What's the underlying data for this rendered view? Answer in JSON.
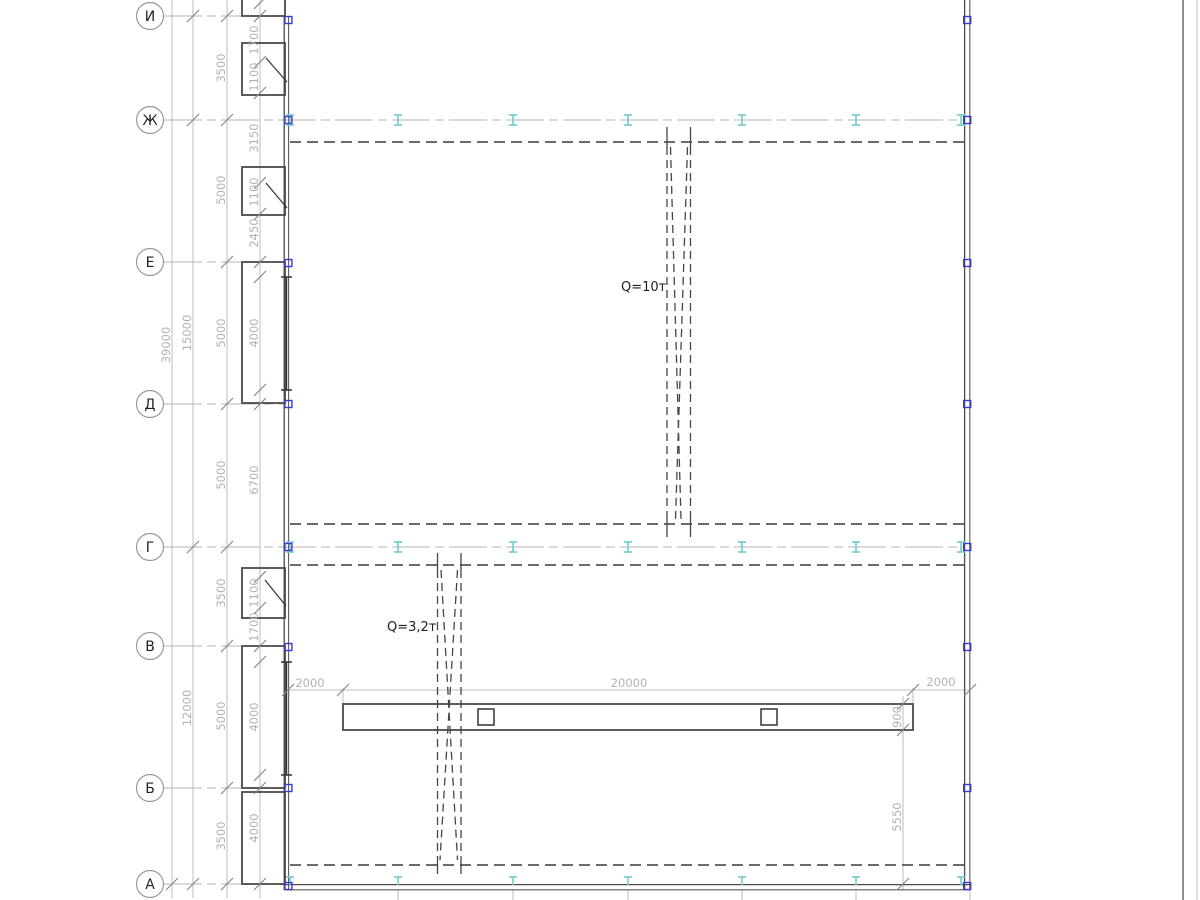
{
  "axes": {
    "labels": [
      "И",
      "Ж",
      "Е",
      "Д",
      "Г",
      "В",
      "Б",
      "А"
    ]
  },
  "dims": {
    "overall": "39000",
    "left": [
      "15000",
      "12000"
    ],
    "bays": [
      "3500",
      "5000",
      "5000",
      "5000",
      "3500",
      "5000",
      "3500"
    ],
    "inner": [
      "1700",
      "1100",
      "3150",
      "1100",
      "2450",
      "4000",
      "6700",
      "1100",
      "1700",
      "4000",
      "4000"
    ],
    "beam": [
      "2000",
      "20000",
      "2000"
    ],
    "beam_side": [
      "900",
      "5550"
    ]
  },
  "cranes": [
    {
      "capacity": "Q=10т"
    },
    {
      "capacity": "Q=3,2т"
    }
  ],
  "colors": {
    "steel_symbol": "#79cccc",
    "column_node": "#3b3bd4",
    "walls": "#4a4a4a",
    "dim_text": "#b2b2b2"
  }
}
